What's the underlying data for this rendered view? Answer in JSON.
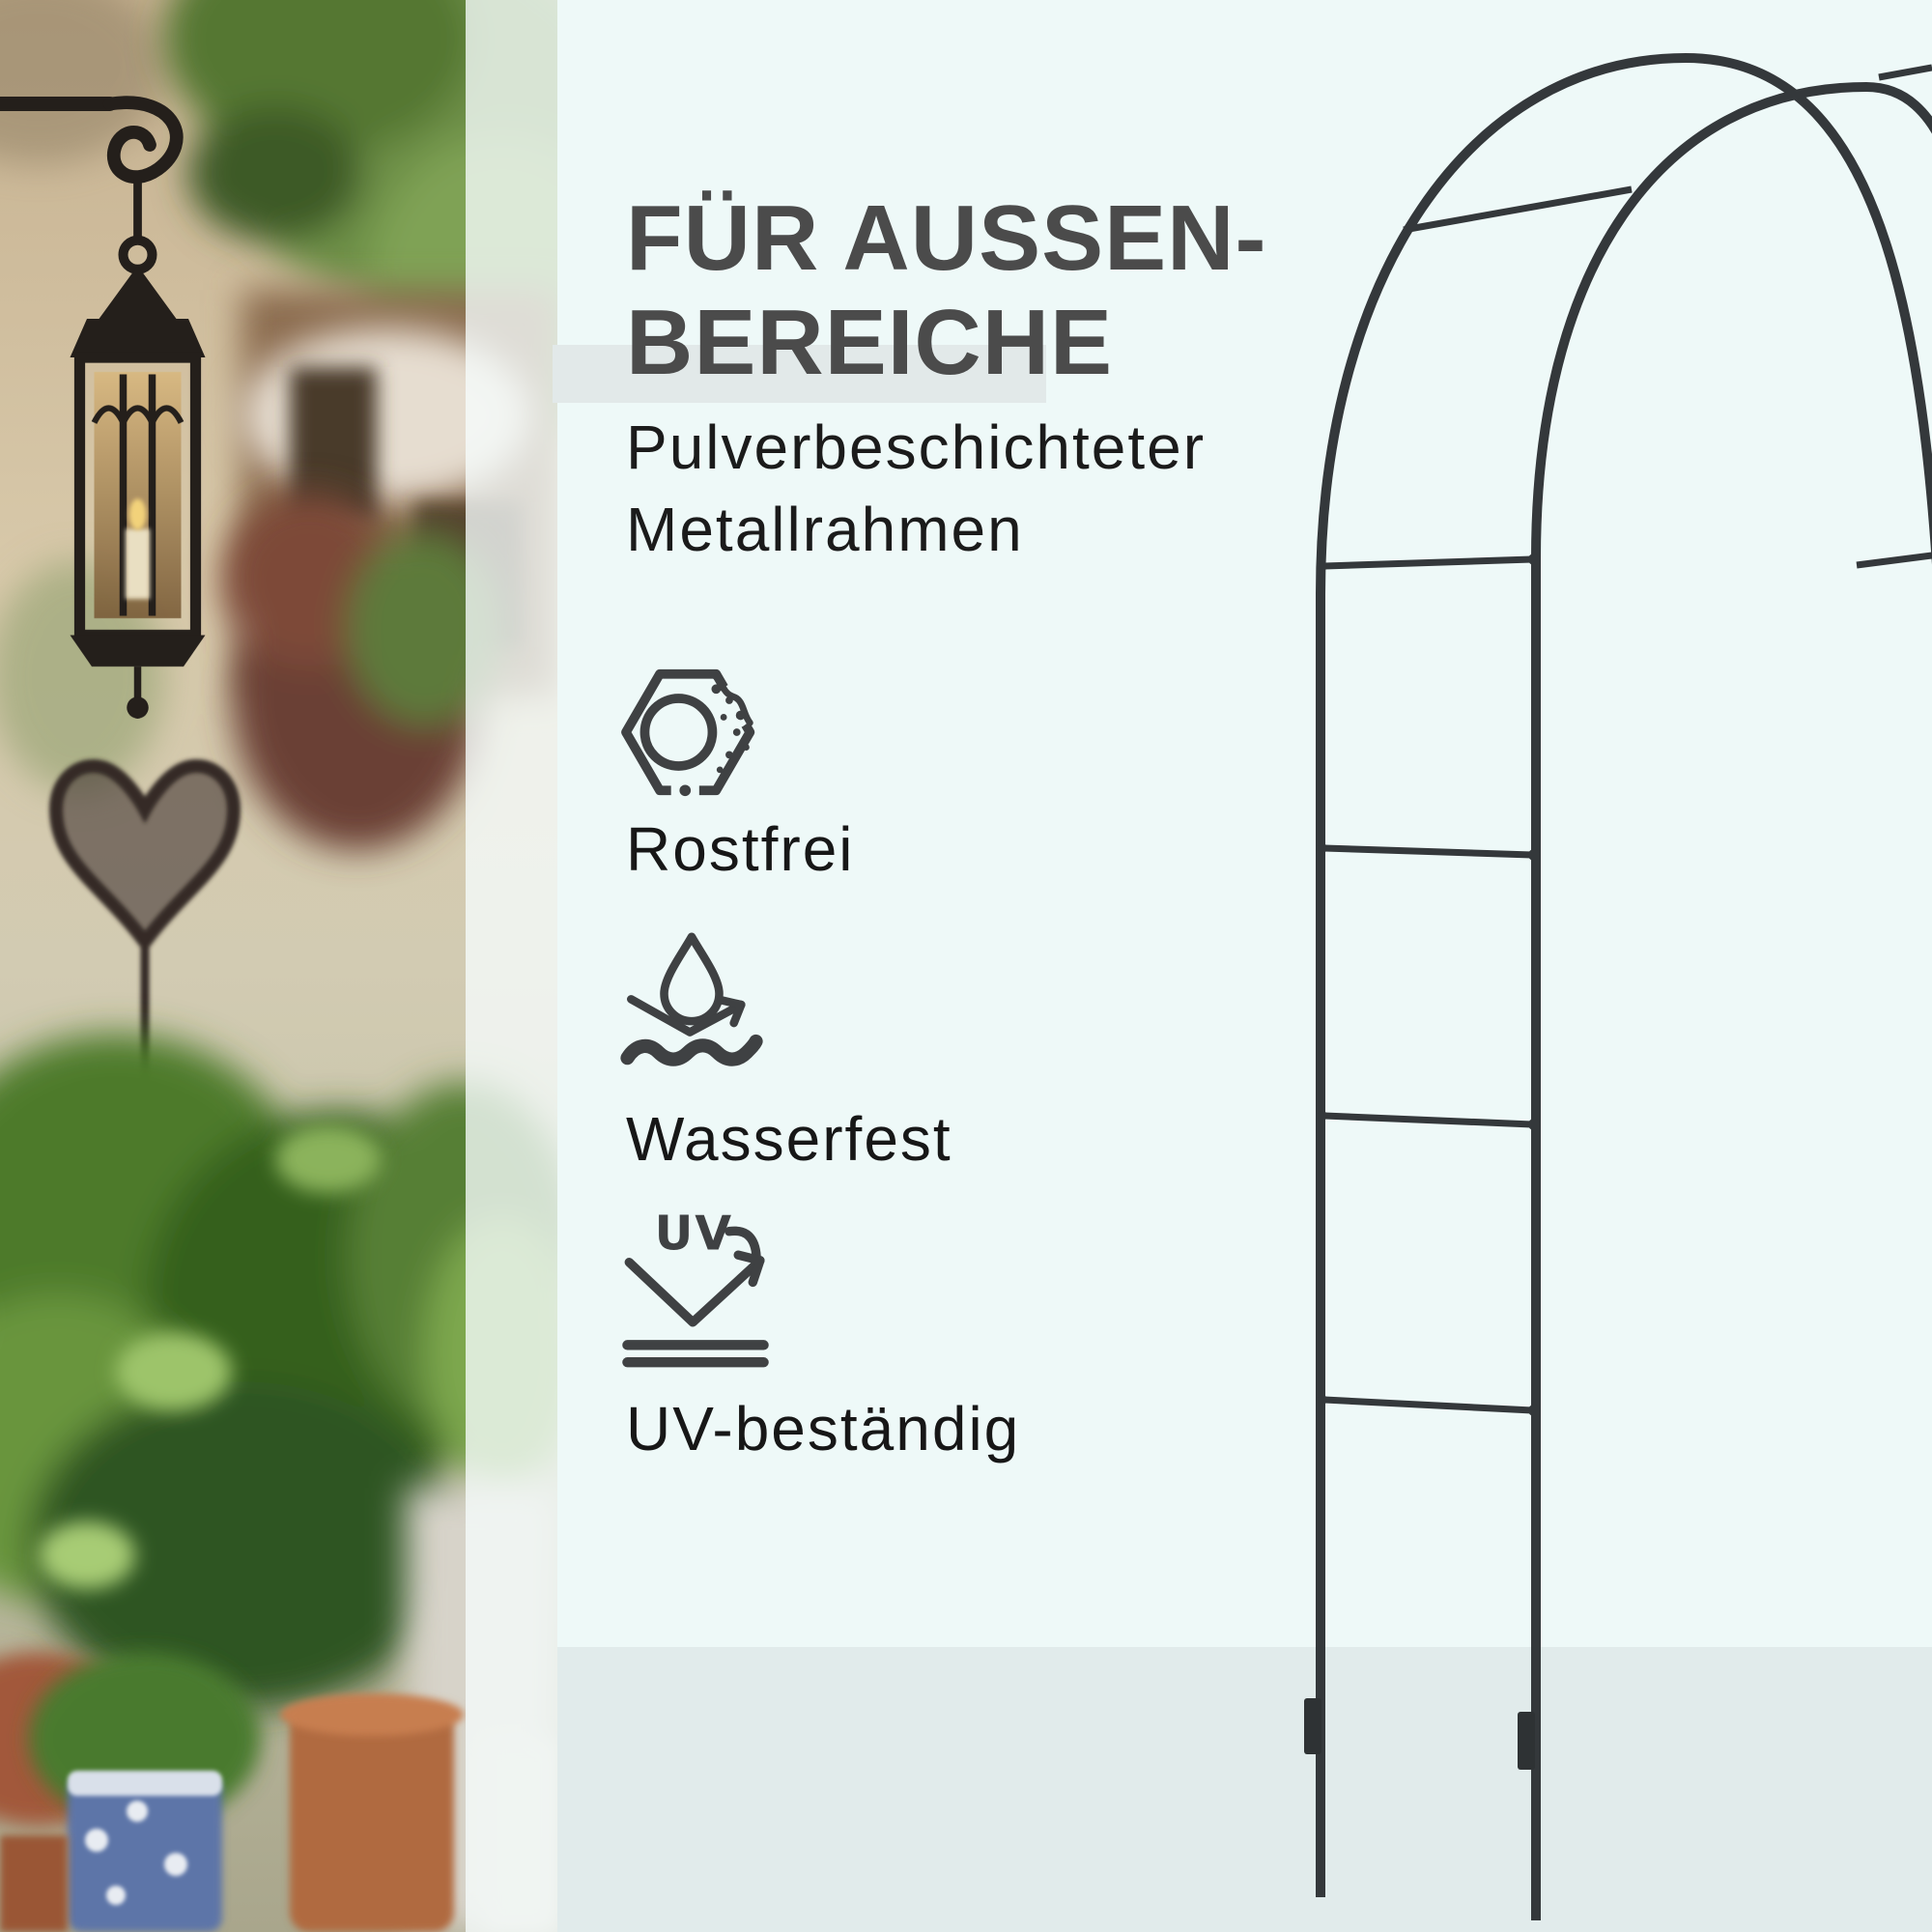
{
  "page": {
    "background_color": "#eef9f8",
    "floor_color": "#e1ebeb",
    "highlight_bar_color": "#e2e9e9"
  },
  "photo": {
    "scene": "garden-courtyard-with-hanging-lantern-plants-and-pots"
  },
  "panel": {
    "title_line1": "FÜR AUSSEN-",
    "title_line2": "BEREICHE",
    "title_color": "#4b4b4b",
    "subtitle_line1": "Pulverbeschichteter",
    "subtitle_line2": "Metallrahmen",
    "text_color": "#171717",
    "icon_color": "#3f4143",
    "features": [
      {
        "icon": "rustproof-nut-icon",
        "label": "Rostfrei"
      },
      {
        "icon": "water-repellent-icon",
        "label": "Wasserfest"
      },
      {
        "icon": "uv-resistant-icon",
        "label": "UV-beständig"
      }
    ],
    "uv_icon_text": "UV"
  },
  "product": {
    "illustration": "black-metal-garden-arch",
    "color": "#34383b"
  }
}
